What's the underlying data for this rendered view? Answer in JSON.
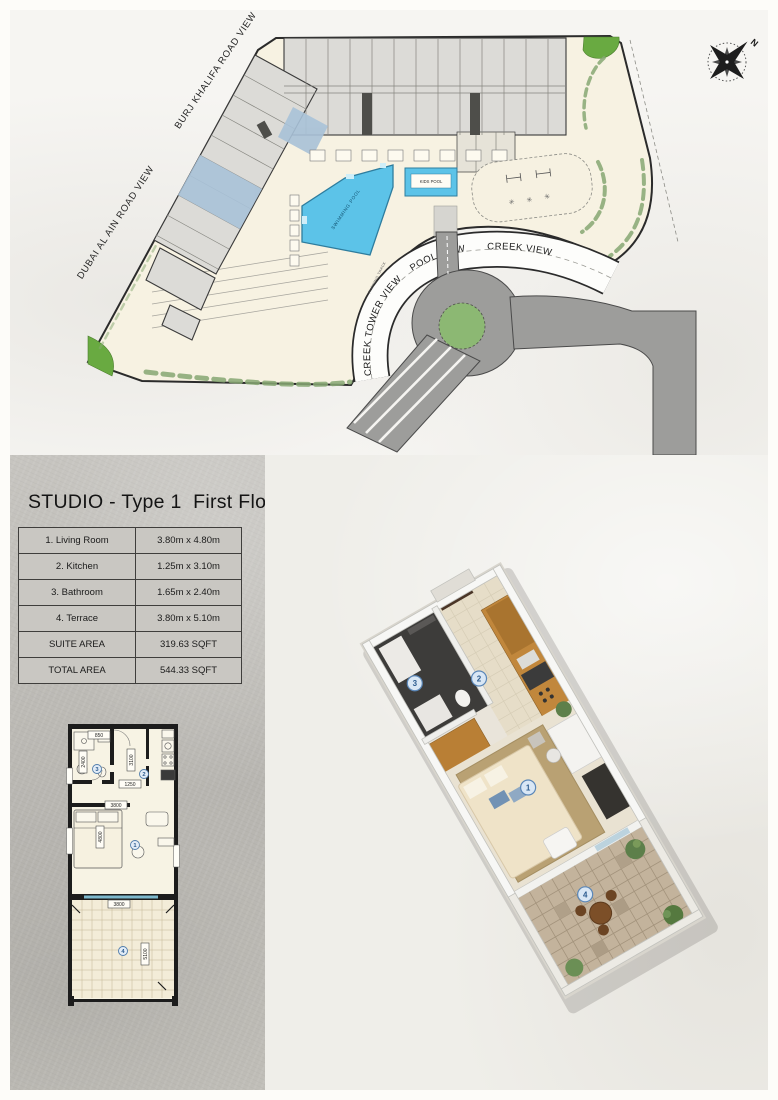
{
  "site": {
    "burj_road_label": "BURJ KHALIFA ROAD VIEW",
    "dubai_road_label": "DUBAI AL AIN ROAD VIEW",
    "creek_tower_label": "CREEK TOWER VIEW",
    "pool_view_label": "POOL VIEW",
    "creek_view_label": "CREEK VIEW",
    "swimming_pool_label": "SWIMMING POOL",
    "kids_pool_label": "KIDS POOL",
    "running_track_label": "RUNNING TRACK",
    "north": "N"
  },
  "studio": {
    "title": "STUDIO - Type 1  First Floor",
    "table": {
      "rows": [
        {
          "label": "1. Living Room",
          "value": "3.80m x 4.80m"
        },
        {
          "label": "2. Kitchen",
          "value": "1.25m x 3.10m"
        },
        {
          "label": "3. Bathroom",
          "value": "1.65m x 2.40m"
        },
        {
          "label": "4. Terrace",
          "value": "3.80m x 5.10m"
        },
        {
          "label": "SUITE AREA",
          "value": "319.63 SQFT"
        },
        {
          "label": "TOTAL AREA",
          "value": "544.33 SQFT"
        }
      ]
    },
    "room_numbers": [
      "1",
      "2",
      "3",
      "4"
    ],
    "dims": {
      "bath_door": "850",
      "bathroom": "2400",
      "kitchen_length": "3100",
      "kitchen_width": "1250",
      "living_width": "3800",
      "living_length": "4800",
      "terrace_width": "3800",
      "terrace_length": "5100"
    }
  },
  "colors": {
    "site": "#f7f2e2",
    "building": "#dcdbd7",
    "unit_highlight": "#a9c2d8",
    "pool": "#5cc3e8",
    "road": "#9d9d9b",
    "green": "#69aa41",
    "hedge": "#87a873",
    "roundabout": "#8cb873"
  }
}
